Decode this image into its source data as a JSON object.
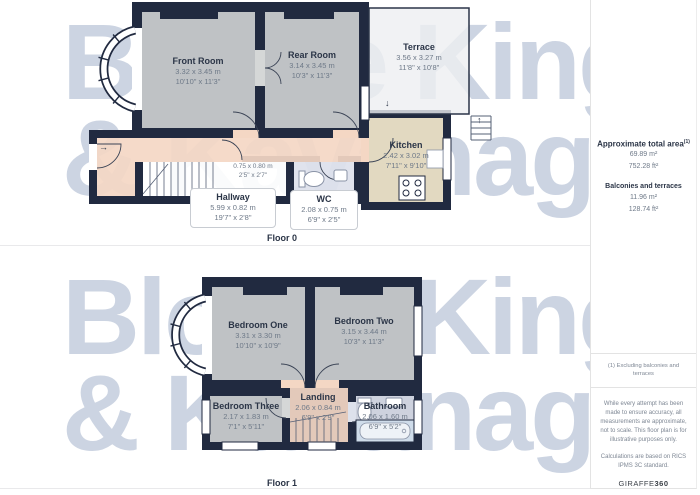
{
  "watermark": {
    "line1": "Bloore King",
    "line2": "& Kavanagh"
  },
  "floor0": {
    "label": "Floor 0",
    "rooms": {
      "front_room": {
        "name": "Front Room",
        "metric": "3.32 x 3.45 m",
        "imperial": "10'10\" x 11'3\""
      },
      "rear_room": {
        "name": "Rear Room",
        "metric": "3.14 x 3.45 m",
        "imperial": "10'3\" x 11'3\""
      },
      "terrace": {
        "name": "Terrace",
        "metric": "3.56 x 3.27 m",
        "imperial": "11'8\" x 10'8\""
      },
      "kitchen": {
        "name": "Kitchen",
        "metric": "2.42 x 3.02 m",
        "imperial": "7'11\" x 9'10\""
      },
      "hallway": {
        "name": "Hallway",
        "metric": "5.99 x 0.82 m",
        "imperial": "19'7\" x 2'8\""
      },
      "wc": {
        "name": "WC",
        "metric": "2.08 x 0.75 m",
        "imperial": "6'9\" x 2'5\""
      },
      "cupboard": {
        "metric": "0.75 x 0.80 m",
        "imperial": "2'5\" x 2'7\""
      }
    }
  },
  "floor1": {
    "label": "Floor 1",
    "rooms": {
      "bedroom_one": {
        "name": "Bedroom One",
        "metric": "3.31 x 3.30 m",
        "imperial": "10'10\" x 10'9\""
      },
      "bedroom_two": {
        "name": "Bedroom Two",
        "metric": "3.15 x 3.44 m",
        "imperial": "10'3\" x 11'3\""
      },
      "bedroom_three": {
        "name": "Bedroom Three",
        "metric": "2.17 x 1.83 m",
        "imperial": "7'1\" x 5'11\""
      },
      "landing": {
        "name": "Landing",
        "metric": "2.06 x 0.84 m",
        "imperial": "6'9\" x 2'9\""
      },
      "bathroom": {
        "name": "Bathroom",
        "metric": "2.06 x 1.60 m",
        "imperial": "6'9\" x 5'2\""
      }
    }
  },
  "sidebar": {
    "total_area_title": "Approximate total area",
    "total_area_superscript": "(1)",
    "total_area_m2": "69.89 m²",
    "total_area_ft2": "752.28 ft²",
    "balconies_title": "Balconies and terraces",
    "balconies_m2": "11.96 m²",
    "balconies_ft2": "128.74 ft²",
    "footnote": "(1) Excluding balconies and terraces",
    "disclaimer1": "While every attempt has been made to ensure accuracy, all measurements are approximate, not to scale. This floor plan is for illustrative purposes only.",
    "disclaimer2": "Calculations are based on RICS IPMS 3C standard.",
    "brand": "GIRAFFE",
    "brand_suffix": "360"
  },
  "arrows": {
    "entrance": "→",
    "terrace_step": "↓",
    "stairs_up": "↑"
  },
  "colors": {
    "wall": "#212a40",
    "room_fill": "#d5d7d7",
    "hallway_fill": "#f4d7c4",
    "kitchen_fill": "#f7eccf",
    "bathroom_fill": "#dde1ec",
    "terrace_fill": "#edeff1",
    "watermark": "#ccd4e2"
  }
}
